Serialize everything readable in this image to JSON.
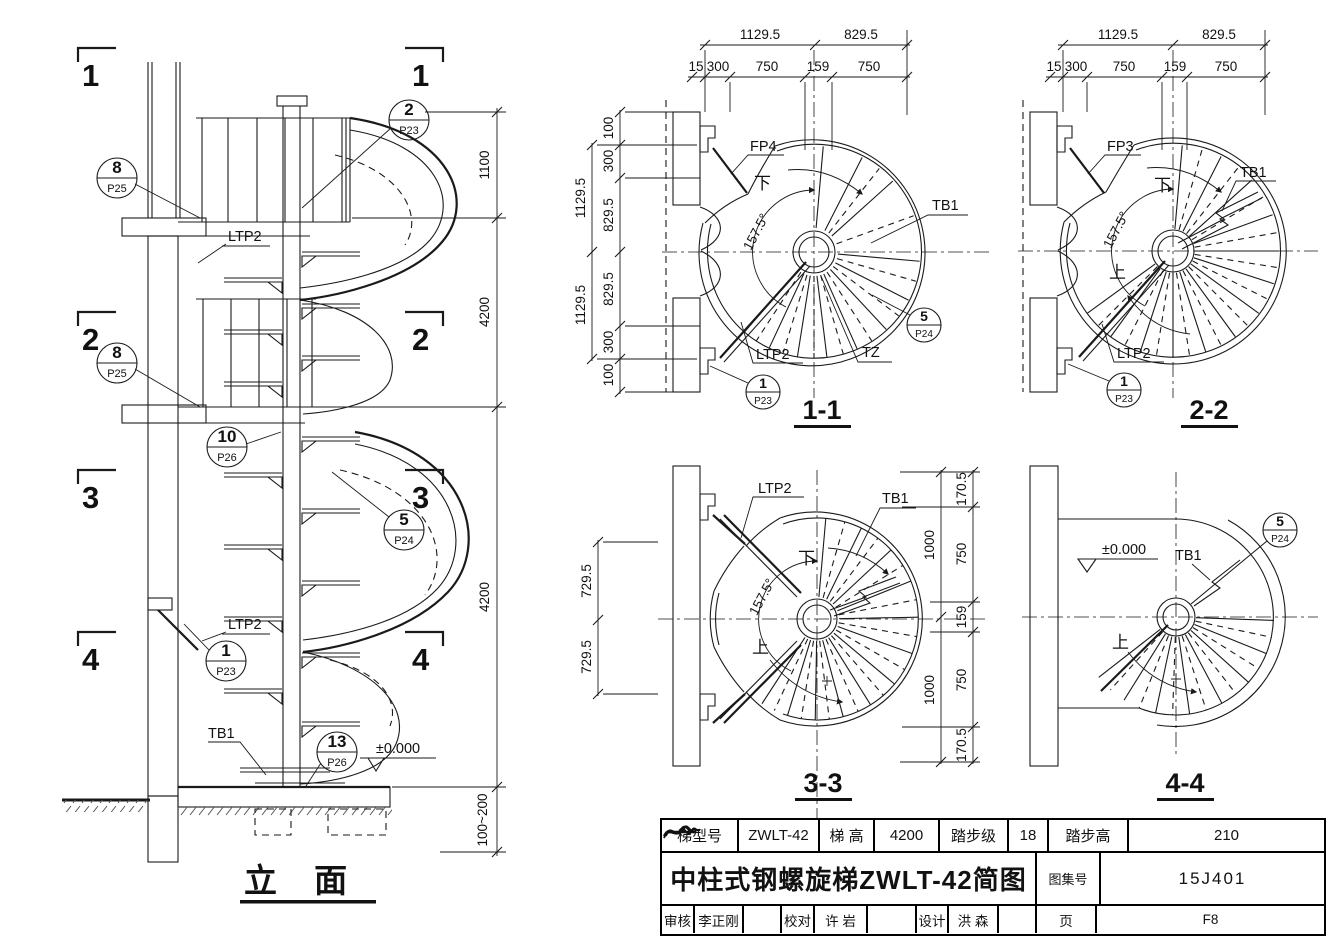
{
  "labels": {
    "ltp2": "LTP2",
    "tb1": "TB1",
    "tz": "TZ",
    "fp4": "FP4",
    "fp3": "FP3",
    "down": "下",
    "up": "上",
    "angle": "157.5°",
    "level": "±0.000"
  },
  "markers": {
    "m1": "1",
    "m2": "2",
    "m3": "3",
    "m4": "4"
  },
  "callouts": {
    "c1": {
      "n": "1",
      "p": "P23"
    },
    "c2": {
      "n": "2",
      "p": "P23"
    },
    "c5": {
      "n": "5",
      "p": "P24"
    },
    "c8": {
      "n": "8",
      "p": "P25"
    },
    "c10": {
      "n": "10",
      "p": "P26"
    },
    "c13": {
      "n": "13",
      "p": "P26"
    }
  },
  "elevation": {
    "title": "立 面",
    "dims": {
      "d1": "1100",
      "d2": "4200",
      "d3": "4200",
      "d4": "100~200"
    }
  },
  "plan_top_dims": {
    "total1": "1129.5",
    "total2": "829.5",
    "s15": "15",
    "s300": "300",
    "s750a": "750",
    "s159": "159",
    "s750b": "750"
  },
  "plan11": {
    "title": "1-1",
    "left_outer": [
      "1129.5",
      "1129.5"
    ],
    "left_inner": [
      "100",
      "300",
      "829.5",
      "829.5",
      "300",
      "100"
    ]
  },
  "plan22": {
    "title": "2-2"
  },
  "plan33": {
    "title": "3-3",
    "left": [
      "729.5",
      "729.5"
    ],
    "right_outer": [
      "1000",
      "1000"
    ],
    "right_inner": [
      "170.5",
      "750",
      "159",
      "750",
      "170.5"
    ]
  },
  "plan44": {
    "title": "4-4"
  },
  "title_block": {
    "spec_rows": [
      {
        "label": "梯型号",
        "value": "ZWLT-42"
      },
      {
        "label": "梯  高",
        "value": "4200"
      },
      {
        "label": "踏步级",
        "value": "18"
      },
      {
        "label": "踏步高",
        "value": "210"
      }
    ],
    "main_title": "中柱式钢螺旋梯ZWLT-42简图",
    "atlas_label": "图集号",
    "atlas_no": "15J401",
    "review_label": "审核",
    "reviewer": "李正刚",
    "check_label": "校对",
    "checker": "许 岩",
    "design_label": "设计",
    "designer": "洪 森",
    "page_label": "页",
    "page_no": "F8"
  }
}
